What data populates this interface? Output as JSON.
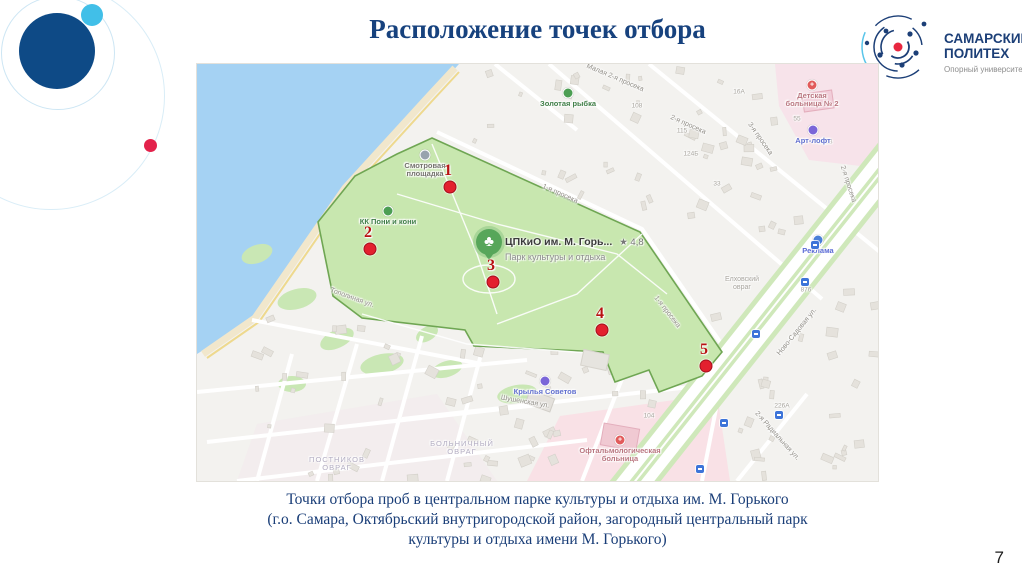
{
  "slide": {
    "title": "Расположение точек отбора",
    "caption_line1": "Точки отбора проб в центральном парке культуры и отдыха им. М. Горького",
    "caption_line2": "(г.о. Самара, Октябрьский внутригородской район, загородный центральный парк",
    "caption_line3": "культуры и отдыха имени М. Горького)",
    "page_number": "7"
  },
  "logo": {
    "title_line1": "САМАРСКИЙ",
    "title_line2": "ПОЛИТЕХ",
    "subtitle": "Опорный университет"
  },
  "colors": {
    "title_blue": "#17427E",
    "sample_point_red": "#E3202E",
    "park_green": "#C8E7AF",
    "water_blue": "#A5D2F3",
    "logo_navy": "#1C3F77",
    "logo_red": "#E8273F"
  },
  "map": {
    "park_marker": {
      "title": "ЦПКиО им. М. Горь...",
      "rating": "★ 4,8",
      "subtitle": "Парк культуры и отдыха"
    },
    "sample_points": [
      {
        "label": "1",
        "x": 253,
        "y": 123
      },
      {
        "label": "2",
        "x": 173,
        "y": 185
      },
      {
        "label": "3",
        "x": 296,
        "y": 218
      },
      {
        "label": "4",
        "x": 405,
        "y": 266
      },
      {
        "label": "5",
        "x": 509,
        "y": 302
      }
    ],
    "pois": [
      {
        "lines": [
          "Золотая рыбка"
        ],
        "x": 371,
        "y": 29,
        "type": "green"
      },
      {
        "lines": [
          "Смотровая",
          "площадка"
        ],
        "x": 228,
        "y": 91,
        "type": "gray"
      },
      {
        "lines": [
          "КК Пони и кони"
        ],
        "x": 191,
        "y": 147,
        "type": "green"
      },
      {
        "lines": [
          "Детская",
          "больница № 2"
        ],
        "x": 615,
        "y": 21,
        "type": "red"
      },
      {
        "lines": [
          "Арт-лофт"
        ],
        "x": 616,
        "y": 66,
        "type": "purple"
      },
      {
        "lines": [
          "Реклама"
        ],
        "x": 621,
        "y": 176,
        "type": "blue"
      },
      {
        "lines": [
          "Крылья Советов"
        ],
        "x": 348,
        "y": 317,
        "type": "purple"
      },
      {
        "lines": [
          "Офтальмологическая",
          "больница"
        ],
        "x": 423,
        "y": 376,
        "type": "red"
      }
    ],
    "streets": [
      {
        "label": "Малая 2-я просека",
        "x": 418,
        "y": 14,
        "rot": 23
      },
      {
        "label": "2-я просека",
        "x": 491,
        "y": 61,
        "rot": 24
      },
      {
        "label": "3-я просека",
        "x": 563,
        "y": 75,
        "rot": 55
      },
      {
        "label": "2-я просека",
        "x": 651,
        "y": 120,
        "rot": 72
      },
      {
        "label": "1-я просека",
        "x": 363,
        "y": 130,
        "rot": 24
      },
      {
        "label": "1-я просека",
        "x": 470,
        "y": 248,
        "rot": 52
      },
      {
        "label": "Ново-Садовая ул.",
        "x": 600,
        "y": 268,
        "rot": -51
      },
      {
        "label": "Тополиная ул.",
        "x": 155,
        "y": 234,
        "rot": 20
      },
      {
        "label": "Шушенская ул.",
        "x": 328,
        "y": 338,
        "rot": 10
      },
      {
        "label": "2-я Радиальная ул.",
        "x": 580,
        "y": 372,
        "rot": 48
      }
    ],
    "areas": [
      {
        "lines": [
          "БОЛЬНИЧНЫЙ",
          "ОВРАГ"
        ],
        "x": 265,
        "y": 384,
        "caps": true
      },
      {
        "lines": [
          "ПОСТНИКОВ",
          "ОВРАГ"
        ],
        "x": 140,
        "y": 400,
        "caps": true
      },
      {
        "lines": [
          "Елховский",
          "овраг"
        ],
        "x": 545,
        "y": 220,
        "caps": false
      }
    ],
    "house_numbers": [
      {
        "label": "115",
        "x": 485,
        "y": 67
      },
      {
        "label": "124Б",
        "x": 494,
        "y": 90
      },
      {
        "label": "108",
        "x": 440,
        "y": 42
      },
      {
        "label": "16А",
        "x": 542,
        "y": 28
      },
      {
        "label": "162В",
        "x": 628,
        "y": 78
      },
      {
        "label": "55",
        "x": 600,
        "y": 55
      },
      {
        "label": "876",
        "x": 609,
        "y": 226
      },
      {
        "label": "226А",
        "x": 585,
        "y": 342
      },
      {
        "label": "104",
        "x": 452,
        "y": 352
      },
      {
        "label": "33",
        "x": 520,
        "y": 120
      }
    ],
    "bus_stops": [
      {
        "x": 618,
        "y": 181
      },
      {
        "x": 608,
        "y": 218
      },
      {
        "x": 559,
        "y": 270
      },
      {
        "x": 582,
        "y": 351
      },
      {
        "x": 527,
        "y": 359
      },
      {
        "x": 503,
        "y": 405
      }
    ]
  }
}
